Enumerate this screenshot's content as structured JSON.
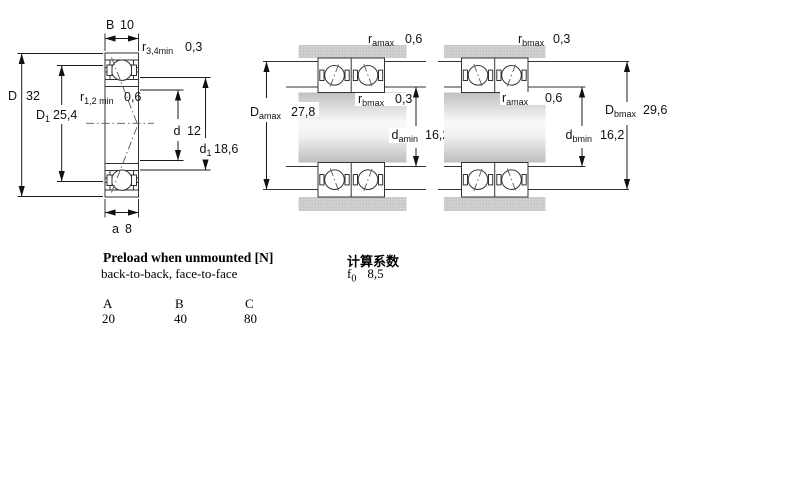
{
  "colors": {
    "hatch_blue": "#c8d7eb",
    "housing_gray": "#cacaca",
    "line_dark": "#222222"
  },
  "figure1": {
    "dims": {
      "B": {
        "label": "B",
        "value": "10"
      },
      "a": {
        "label": "a",
        "value": "8"
      },
      "D": {
        "label": "D",
        "value": "32"
      },
      "D1": {
        "label": "D",
        "sub": "1",
        "value": "25,4"
      },
      "d": {
        "label": "d",
        "value": "12"
      },
      "d1": {
        "label": "d",
        "sub": "1",
        "value": "18,6"
      },
      "r34": {
        "label": "r",
        "sub": "3,4min",
        "value": "0,3"
      },
      "r12": {
        "label": "r",
        "sub": "1,2 min",
        "value": "0,6"
      }
    }
  },
  "figure2": {
    "dims": {
      "ra": {
        "label": "r",
        "sub": "amax",
        "value": "0,6"
      },
      "rb": {
        "label": "r",
        "sub": "bmax",
        "value": "0,3"
      },
      "Da": {
        "label": "D",
        "sub": "amax",
        "value": "27,8"
      },
      "da": {
        "label": "d",
        "sub": "amin",
        "value": "16,2"
      }
    }
  },
  "figure3": {
    "dims": {
      "rb": {
        "label": "r",
        "sub": "bmax",
        "value": "0,3"
      },
      "ra": {
        "label": "r",
        "sub": "amax",
        "value": "0,6"
      },
      "Db": {
        "label": "D",
        "sub": "bmax",
        "value": "29,6"
      },
      "db": {
        "label": "d",
        "sub": "bmin",
        "value": "16,2"
      }
    }
  },
  "preload": {
    "title": "Preload when unmounted [N]",
    "subtitle": "back-to-back, face-to-face",
    "columns": [
      "A",
      "B",
      "C"
    ],
    "values": [
      "20",
      "40",
      "80"
    ]
  },
  "calc": {
    "title": "计算系数",
    "factor_label": "f",
    "factor_sub": "0",
    "factor_value": "8,5"
  }
}
